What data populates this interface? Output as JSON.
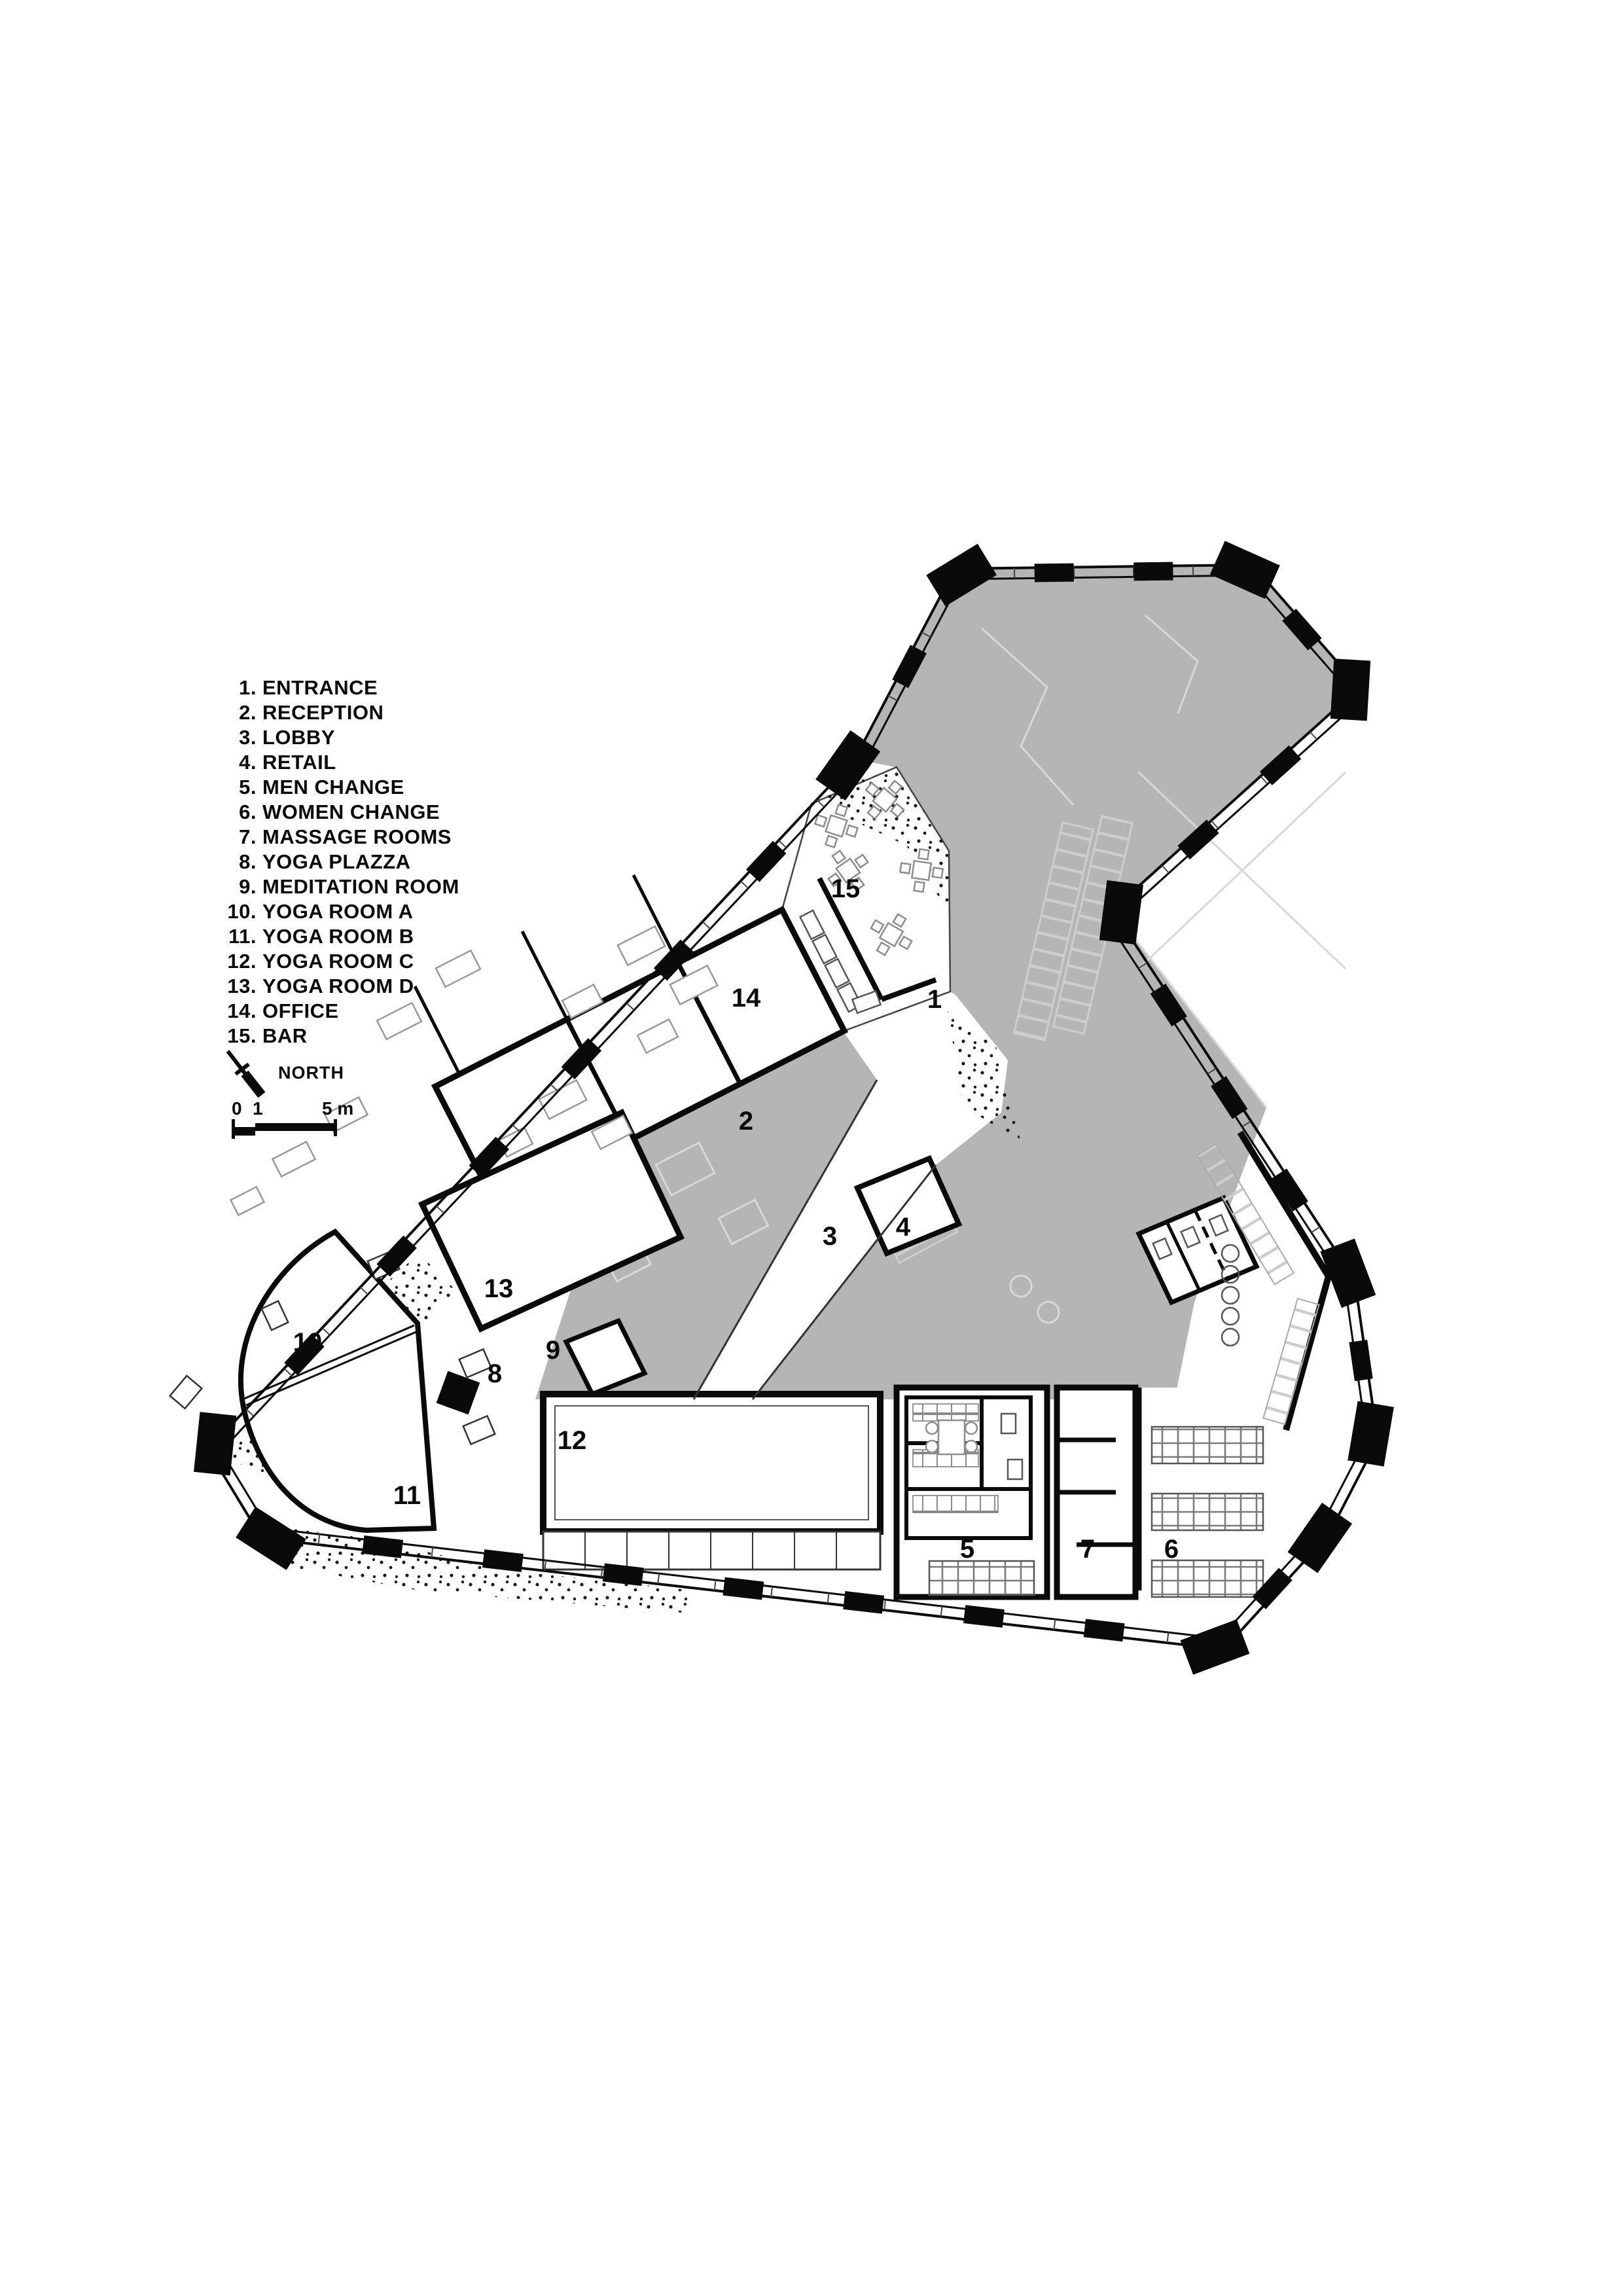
{
  "legend": {
    "items": [
      {
        "num": "1.",
        "label": "ENTRANCE"
      },
      {
        "num": "2.",
        "label": "RECEPTION"
      },
      {
        "num": "3.",
        "label": "LOBBY"
      },
      {
        "num": "4.",
        "label": "RETAIL"
      },
      {
        "num": "5.",
        "label": "MEN CHANGE"
      },
      {
        "num": "6.",
        "label": "WOMEN CHANGE"
      },
      {
        "num": "7.",
        "label": "MASSAGE ROOMS"
      },
      {
        "num": "8.",
        "label": "YOGA PLAZZA"
      },
      {
        "num": "9.",
        "label": "MEDITATION ROOM"
      },
      {
        "num": "10.",
        "label": "YOGA ROOM A"
      },
      {
        "num": "11.",
        "label": "YOGA ROOM B"
      },
      {
        "num": "12.",
        "label": "YOGA ROOM C"
      },
      {
        "num": "13.",
        "label": "YOGA ROOM D"
      },
      {
        "num": "14.",
        "label": "OFFICE"
      },
      {
        "num": "15.",
        "label": "BAR"
      }
    ]
  },
  "north_label": "NORTH",
  "scale_bar": {
    "tick_zero": "0",
    "tick_one": "1",
    "tick_five": "5 m"
  },
  "plan": {
    "room_labels": [
      "1",
      "2",
      "3",
      "4",
      "5",
      "6",
      "7",
      "8",
      "9",
      "10",
      "11",
      "12",
      "13",
      "14",
      "15"
    ]
  },
  "colors": {
    "void_gray": "#b5b5b5",
    "wall_black": "#0a0a0a",
    "ghost_line": "#d8d8d8"
  }
}
